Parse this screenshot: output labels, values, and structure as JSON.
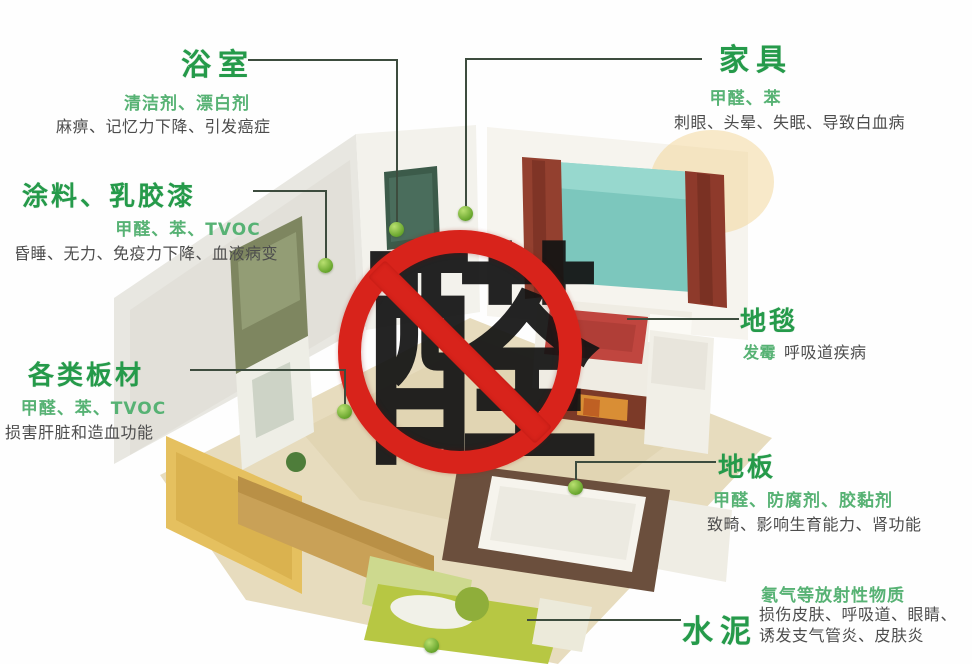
{
  "sign": {
    "character": "醛",
    "meaning": "aldehyde-prohibited-symbol",
    "ring_color": "#d8231b",
    "character_color": "#141414"
  },
  "colors": {
    "title_green": "#259a4a",
    "pollutant_green": "#57b274",
    "effect_gray": "#4d4d4d",
    "leader_line": "#3d4c3e",
    "marker_dot": "#67a52c"
  },
  "callouts": [
    {
      "id": "bathroom",
      "title": "浴室",
      "pollutants": "清洁剂、漂白剂",
      "effects": "麻痹、记忆力下降、引发癌症"
    },
    {
      "id": "paint",
      "title": "涂料、乳胶漆",
      "pollutants": "甲醛、苯、TVOC",
      "effects": "昏睡、无力、免疫力下降、血液病变"
    },
    {
      "id": "boards",
      "title": "各类板材",
      "pollutants": "甲醛、苯、TVOC",
      "effects": "损害肝脏和造血功能"
    },
    {
      "id": "furniture",
      "title": "家具",
      "pollutants": "甲醛、苯",
      "effects": "刺眼、头晕、失眠、导致白血病"
    },
    {
      "id": "carpet",
      "title": "地毯",
      "pollutants": "发霉",
      "effects": "呼吸道疾病"
    },
    {
      "id": "floor",
      "title": "地板",
      "pollutants": "甲醛、防腐剂、胶黏剂",
      "effects": "致畸、影响生育能力、肾功能"
    },
    {
      "id": "cement",
      "title": "水泥",
      "pollutants": "氡气等放射性物质",
      "effects": "损伤皮肤、呼吸道、眼睛、诱发支气管炎、皮肤炎"
    }
  ]
}
